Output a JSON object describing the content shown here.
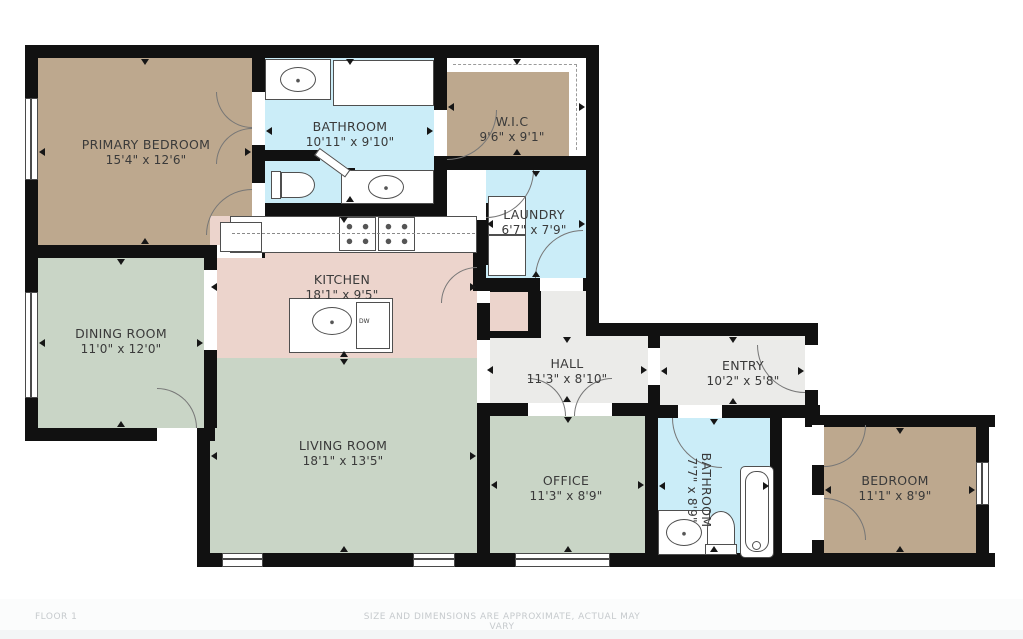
{
  "meta": {
    "floor_label": "FLOOR 1",
    "disclaimer": "SIZE AND DIMENSIONS ARE APPROXIMATE, ACTUAL MAY VARY"
  },
  "palette": {
    "bedroom_tan": "#bda88e",
    "bath_blue": "#cbedf8",
    "kitchen_pink": "#ecd4cc",
    "living_green": "#c9d5c6",
    "hall_gray": "#ebebe9",
    "wall_black": "#111111",
    "label_text": "#3a3a3a",
    "footer_text": "#c6cacd"
  },
  "rooms": [
    {
      "id": "primary-bedroom",
      "name": "PRIMARY BEDROOM",
      "dims": "15'4\" x 12'6\""
    },
    {
      "id": "bathroom-1",
      "name": "BATHROOM",
      "dims": "10'11\" x 9'10\""
    },
    {
      "id": "wic",
      "name": "W.I.C",
      "dims": "9'6\" x 9'1\""
    },
    {
      "id": "laundry",
      "name": "LAUNDRY",
      "dims": "6'7\" x 7'9\""
    },
    {
      "id": "kitchen",
      "name": "KITCHEN",
      "dims": "18'1\" x 9'5\""
    },
    {
      "id": "dining-room",
      "name": "DINING ROOM",
      "dims": "11'0\" x 12'0\""
    },
    {
      "id": "hall",
      "name": "HALL",
      "dims": "11'3\" x 8'10\""
    },
    {
      "id": "entry",
      "name": "ENTRY",
      "dims": "10'2\" x 5'8\""
    },
    {
      "id": "living-room",
      "name": "LIVING ROOM",
      "dims": "18'1\" x 13'5\""
    },
    {
      "id": "office",
      "name": "OFFICE",
      "dims": "11'3\" x 8'9\""
    },
    {
      "id": "bathroom-2",
      "name": "BATHROOM",
      "dims": "7'7\" x 8'9\""
    },
    {
      "id": "bedroom-2",
      "name": "BEDROOM",
      "dims": "11'1\" x 8'9\""
    }
  ],
  "fixtures": {
    "dishwasher_label": "DW"
  }
}
